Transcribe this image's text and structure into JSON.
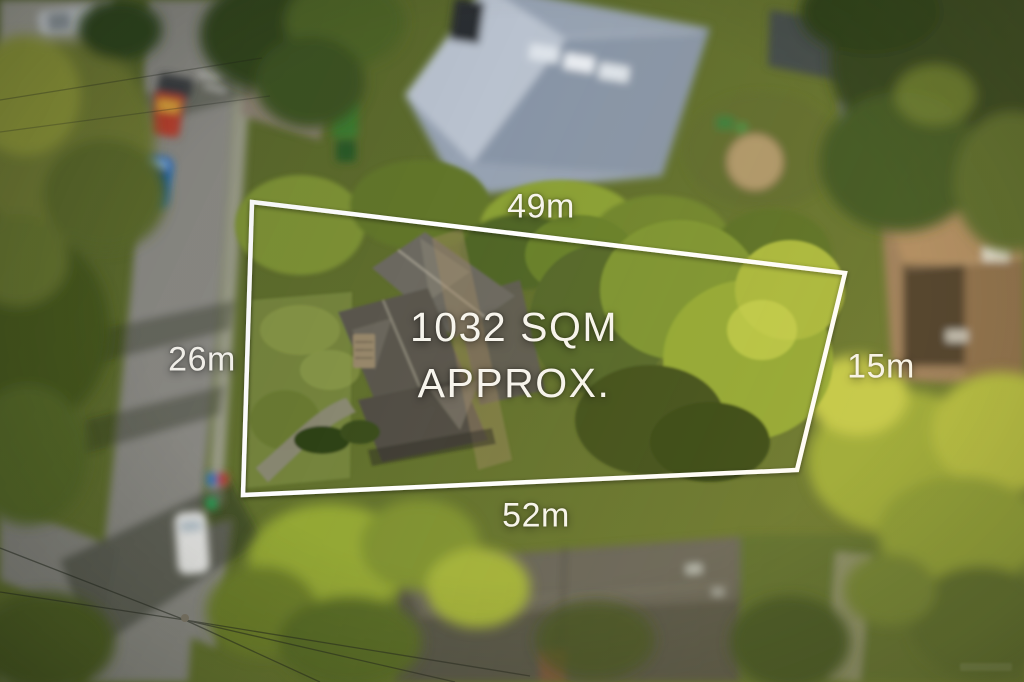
{
  "overlay": {
    "area_label": {
      "line1": "1032 SQM",
      "line2": "APPROX."
    },
    "dimensions": {
      "top": "49m",
      "left": "26m",
      "right": "15m",
      "bottom": "52m"
    },
    "boundary": {
      "points": "252,202 845,273 797,470 243,495",
      "stroke_color": "#ffffff",
      "stroke_width": "4.5"
    },
    "text_color": "#f7f5ee"
  },
  "scene_colors": {
    "foliage_dark": "#31451c",
    "foliage_olive": "#6f7a31",
    "foliage_sunlit": "#b3bd3f",
    "road_asphalt": "#8b8a84",
    "metal_roof": "#96a2b2",
    "shingle_roof": "#5a574d",
    "brown_roof": "#9b7d5c"
  }
}
